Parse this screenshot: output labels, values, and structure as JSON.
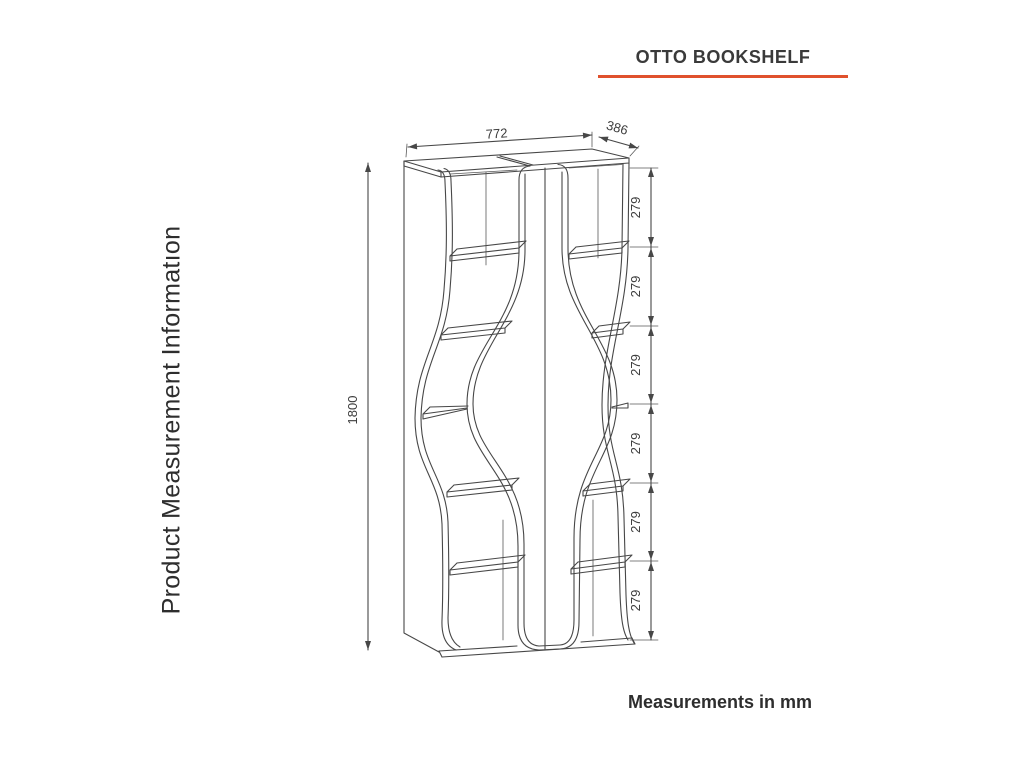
{
  "page": {
    "background": "#ffffff"
  },
  "header": {
    "title": "OTTO BOOKSHELF",
    "underline_color": "#e0512d"
  },
  "sidebar": {
    "label": "Product Measurement Informatıon"
  },
  "footer": {
    "note": "Measurements in mm"
  },
  "drawing": {
    "product": "wavy two-column bookshelf, isometric line drawing",
    "line_color": "#474747",
    "text_color": "#3c3c3c",
    "dimensions": {
      "width": "772",
      "depth": "386",
      "height": "1800",
      "segments": [
        "279",
        "279",
        "279",
        "279",
        "279",
        "279"
      ]
    }
  }
}
